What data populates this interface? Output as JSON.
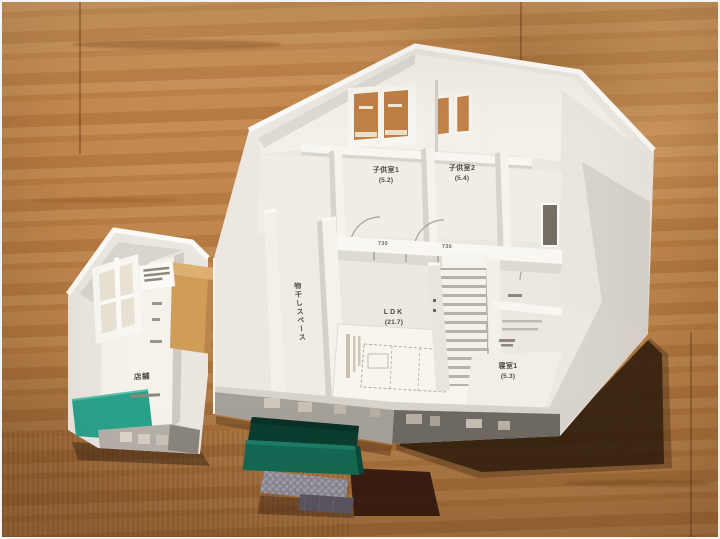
{
  "photo": {
    "subject": "Architectural scale model of a house interior floor plan on a wooden table",
    "palette": {
      "table_wood": "#c08347",
      "model_white": "#f2efe8",
      "porch_green": "#146954",
      "annex_floor_teal": "#2aa28b",
      "kraft_block": "#d09d59",
      "tile_grey": "#9b99a4"
    }
  },
  "rooms": {
    "child_room_1": {
      "label": "子供室1",
      "area": "(5.2)"
    },
    "child_room_2": {
      "label": "子供室2",
      "area": "(5.4)"
    },
    "ldk": {
      "label": "LDK",
      "area": "(21.7)"
    },
    "drying_space": {
      "label": "物干しスペース"
    },
    "bedroom_1": {
      "label": "寝室1",
      "area": "(5.3)"
    },
    "shop": {
      "label": "店舗"
    }
  },
  "dimensions": {
    "dim_left": "730",
    "dim_right": "730"
  }
}
